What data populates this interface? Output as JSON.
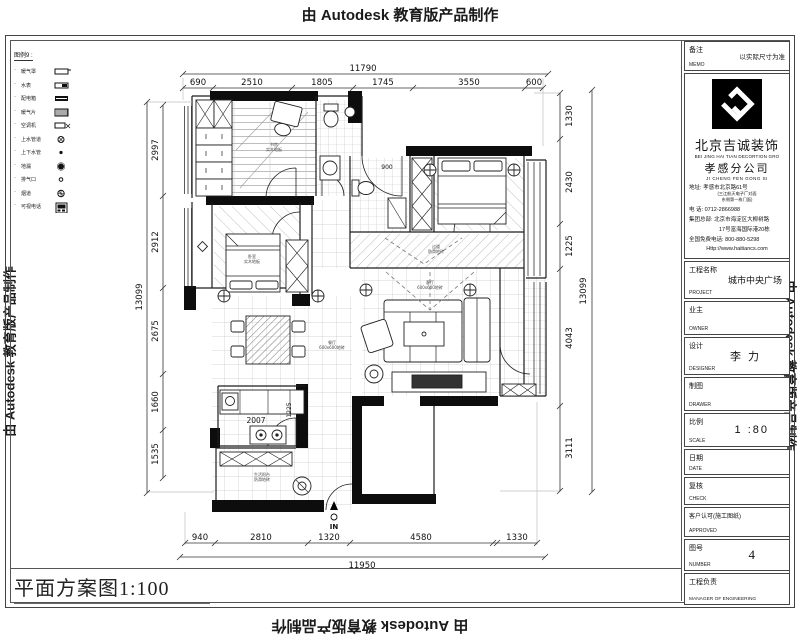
{
  "watermarks": {
    "autodesk": "由 Autodesk 教育版产品制作"
  },
  "sheet": {
    "title": "平面方案图1:100"
  },
  "legend": {
    "header": "图例9 :",
    "items": [
      {
        "label": "暖气罩"
      },
      {
        "label": "水表"
      },
      {
        "label": "配电箱"
      },
      {
        "label": "暖气片"
      },
      {
        "label": "空调机"
      },
      {
        "label": "上水管道"
      },
      {
        "label": "上下水管"
      },
      {
        "label": "地漏"
      },
      {
        "label": "排气口"
      },
      {
        "label": "烟道"
      },
      {
        "label": "可视电话"
      }
    ]
  },
  "dims": {
    "top": {
      "total": "11790",
      "segments": [
        "690",
        "2510",
        "1805",
        "1745",
        "3550",
        "600"
      ]
    },
    "bottom": {
      "total": "11950",
      "segments": [
        "940",
        "2810",
        "1320",
        "4580",
        "1330"
      ]
    },
    "left": {
      "total": "13099",
      "segments": [
        "2997",
        "2912",
        "2675",
        "1660",
        "1535"
      ]
    },
    "right": {
      "total": "13099",
      "segments": [
        "1330",
        "2430",
        "1225",
        "4043",
        "3111"
      ]
    }
  },
  "plan": {
    "entry_label": "IN",
    "door_dim": "900",
    "kitchen_counter_dim": "2007",
    "kitchen_depth_dim": "1225",
    "labels": [
      {
        "line1": "书房",
        "line2": "实木地板"
      },
      {
        "line1": "卧室",
        "line2": "实木地板"
      },
      {
        "line1": "过道",
        "line2": "防滑地砖"
      },
      {
        "line1": "餐厅",
        "line2": "600x600地砖"
      },
      {
        "line1": "客厅",
        "line2": "600x600地砖"
      },
      {
        "line1": "生活阳台",
        "line2": "防滑地砖"
      }
    ]
  },
  "title_block": {
    "memo": {
      "cn": "备注",
      "en": "MEMO",
      "value": "以实际尺寸为准"
    },
    "company": {
      "name_cn": "北京吉诚装饰",
      "name_en": "BEI JING HAI TIAN DECORTION GRO",
      "branch_cn": "孝感分公司",
      "branch_en": "JI CHENG FEN GONG SI",
      "address_label": "地址:",
      "address": "孝感市北京路61号",
      "address_note1": "(三江航天电子厂对面",
      "address_note2": "东侧第一栋门面)",
      "phone_label": "电    话:",
      "phone": "0712-2866988",
      "hq_label": "集团总部:",
      "hq1": "北京市海淀区大柳树路",
      "hq2": "17号富海国际港20栋",
      "hotline_label": "全国免费电话:",
      "hotline": "800-880-5298",
      "website": "Http://www.haitiancs.com"
    },
    "rows": [
      {
        "cn": "工程名称",
        "en": "PROJECT",
        "value": "城市中央广场"
      },
      {
        "cn": "业主",
        "en": "OWNER",
        "value": ""
      },
      {
        "cn": "设计",
        "en": "DESIGNER",
        "value": "李 力"
      },
      {
        "cn": "制图",
        "en": "DRAWER",
        "value": ""
      },
      {
        "cn": "比例",
        "en": "SCALE",
        "value": "1 :80"
      },
      {
        "cn": "日期",
        "en": "DATE",
        "value": ""
      },
      {
        "cn": "复核",
        "en": "CHECK",
        "value": ""
      },
      {
        "cn": "客户认可(施工图纸)",
        "en": "APPROVED",
        "value": ""
      },
      {
        "cn": "图号",
        "en": "NUMBER",
        "value": "4"
      },
      {
        "cn": "工程负责",
        "en": "MANAGER OF ENGINEERING",
        "value": ""
      }
    ]
  }
}
